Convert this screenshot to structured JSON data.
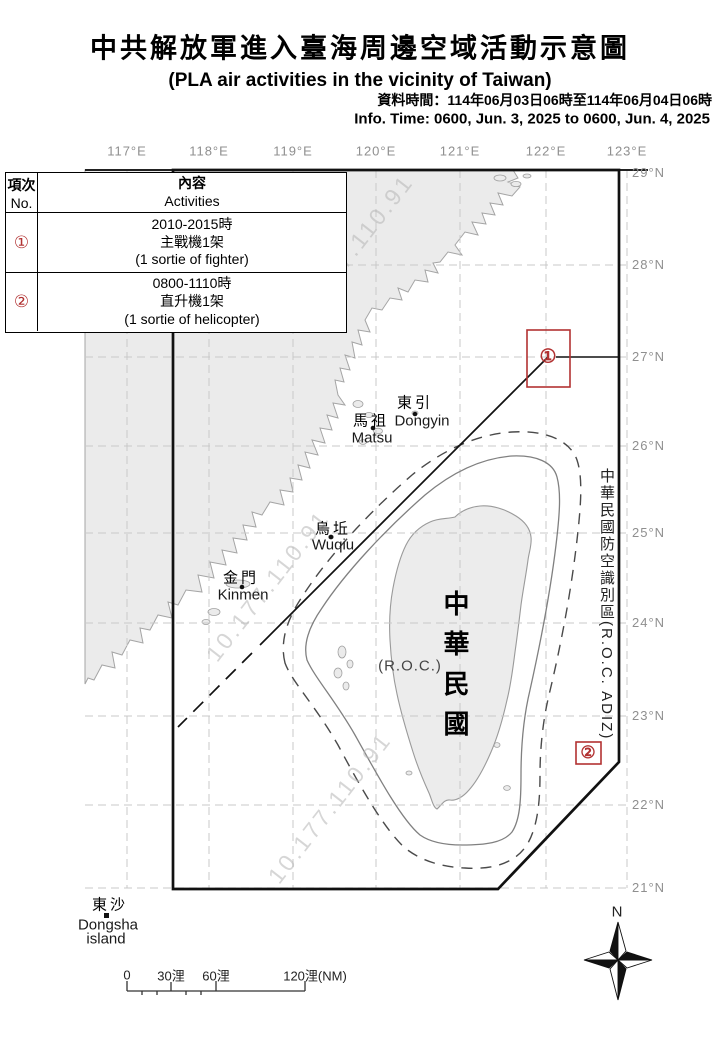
{
  "header": {
    "title_zh": "中共解放軍進入臺海周邊空域活動示意圖",
    "title_en": "(PLA air activities in the vicinity of Taiwan)",
    "info_zh": "資料時間：114年06月03日06時至114年06月04日06時",
    "info_en": "Info. Time: 0600, Jun. 3, 2025 to 0600, Jun. 4, 2025"
  },
  "activity_table": {
    "col_no_zh": "項次",
    "col_no_en": "No.",
    "col_act_zh": "內容",
    "col_act_en": "Activities",
    "rows": [
      {
        "no": "①",
        "time": "2010-2015時",
        "type_zh": "主戰機1架",
        "type_en": "(1 sortie of fighter)"
      },
      {
        "no": "②",
        "time": "0800-1110時",
        "type_zh": "直升機1架",
        "type_en": "(1 sortie of helicopter)"
      }
    ]
  },
  "map": {
    "lon_labels": [
      "117°E",
      "118°E",
      "119°E",
      "120°E",
      "121°E",
      "122°E",
      "123°E"
    ],
    "lat_labels": [
      "29°N",
      "28°N",
      "27°N",
      "26°N",
      "25°N",
      "24°N",
      "23°N",
      "22°N",
      "21°N"
    ],
    "adiz_label": "中華民國防空識別區(R.O.C. ADIZ)",
    "taiwan_zh": "中華民國",
    "taiwan_en": "(R.O.C.)",
    "places": {
      "dongyin_zh": "東引",
      "dongyin_en": "Dongyin",
      "matsu_zh": "馬祖",
      "matsu_en": "Matsu",
      "wuqiu_zh": "烏坵",
      "wuqiu_en": "Wuqiu",
      "kinmen_zh": "金門",
      "kinmen_en": "Kinmen",
      "dongsha_zh": "東沙",
      "dongsha_en1": "Dongsha",
      "dongsha_en2": "island"
    },
    "markers": [
      {
        "no": "①"
      },
      {
        "no": "②"
      }
    ],
    "compass_n": "N",
    "watermark": "10.177.110.91",
    "scalebar": {
      "t0": "0",
      "t30": "30浬",
      "t60": "60浬",
      "t120": "120浬(NM)"
    }
  },
  "colors": {
    "marker_red": "#b23232",
    "land_gray": "#ebebeb",
    "grid_gray": "#c8c8c8",
    "geo_label_gray": "#8f8f8f",
    "adiz_line": "#111111"
  }
}
